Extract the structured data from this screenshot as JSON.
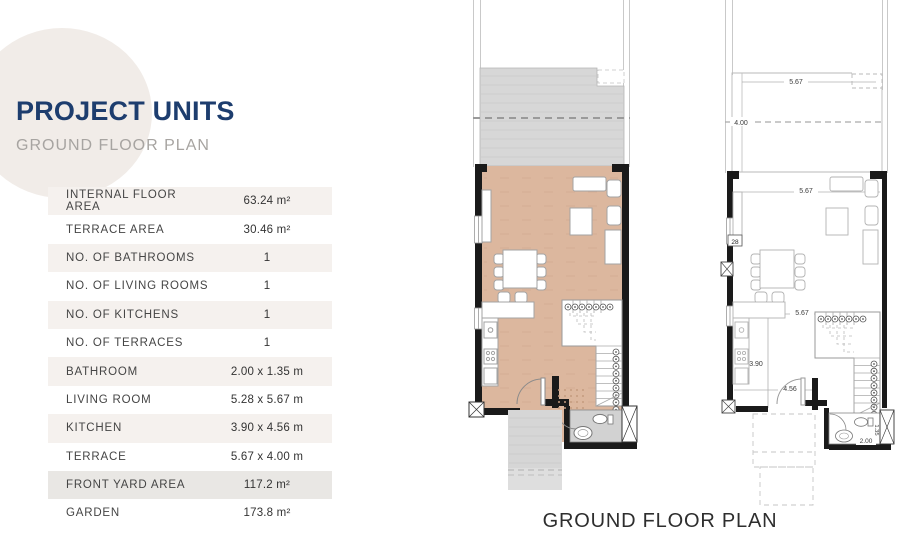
{
  "header": {
    "title": "PROJECT UNITS",
    "subtitle": "GROUND FLOOR PLAN"
  },
  "spec_table": {
    "rows": [
      {
        "label": "INTERNAL FLOOR AREA",
        "value": "63.24 m²"
      },
      {
        "label": "TERRACE AREA",
        "value": "30.46 m²"
      },
      {
        "label": "NO. OF BATHROOMS",
        "value": "1"
      },
      {
        "label": "NO. OF LIVING ROOMS",
        "value": "1"
      },
      {
        "label": "NO. OF KITCHENS",
        "value": "1"
      },
      {
        "label": "NO. OF TERRACES",
        "value": "1"
      },
      {
        "label": "BATHROOM",
        "value": "2.00 x 1.35 m"
      },
      {
        "label": "LIVING ROOM",
        "value": "5.28 x 5.67 m"
      },
      {
        "label": "KITCHEN",
        "value": "3.90 x 4.56 m"
      },
      {
        "label": "TERRACE",
        "value": "5.67 x 4.00 m"
      },
      {
        "label": "FRONT YARD AREA",
        "value": "117.2 m²"
      },
      {
        "label": "GARDEN",
        "value": "173.8 m²"
      }
    ]
  },
  "floor_plans": {
    "caption": "GROUND FLOOR PLAN",
    "dimensions": {
      "terrace_width": "5.67",
      "terrace_depth": "4.00",
      "living_width": "5.67",
      "living_depth_partial": "28",
      "interior_width": "5.67",
      "kitchen_depth": "3.90",
      "kitchen_width": "4.56",
      "bathroom_width": "2.00",
      "bathroom_depth": "1.35"
    }
  },
  "colors": {
    "title": "#1d3d6e",
    "subtitle": "#a7a4a1",
    "row_beige": "#f5f1ee",
    "row_highlight": "#e9e7e4",
    "floor_fill": "#dcb79e",
    "terrace_fill": "#d7d7d7",
    "bathroom_fill": "#d2d2d2",
    "wall": "#1a1a1a",
    "backdrop_ellipse": "#f1ece8"
  }
}
